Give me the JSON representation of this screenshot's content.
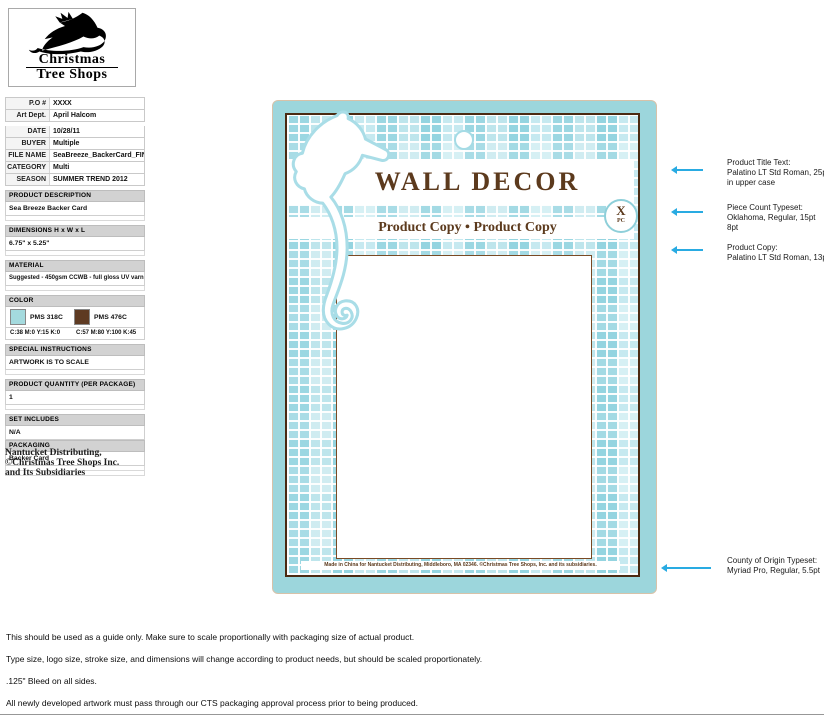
{
  "logo": {
    "line1": "Christmas",
    "line2": "Tree Shops"
  },
  "spec": {
    "fields": [
      {
        "label": "P.O #",
        "value": "XXXX"
      },
      {
        "label": "Art Dept.",
        "value": "April Halcom"
      },
      {
        "label": "DATE",
        "value": "10/28/11"
      },
      {
        "label": "BUYER",
        "value": "Multiple"
      },
      {
        "label": "FILE NAME",
        "value": "SeaBreeze_BackerCard_FINAL.ai"
      },
      {
        "label": "CATEGORY",
        "value": "Multi"
      },
      {
        "label": "SEASON",
        "value": "SUMMER TREND 2012"
      }
    ],
    "sections": {
      "description": {
        "header": "PRODUCT DESCRIPTION",
        "value": "Sea Breeze Backer Card"
      },
      "dimensions": {
        "header": "DIMENSIONS H x W x L",
        "value": "6.75\" x 5.25\""
      },
      "material": {
        "header": "MATERIAL",
        "value": "Suggested - 450gsm CCWB - full gloss UV varnish"
      },
      "color": {
        "header": "COLOR",
        "swatches": [
          {
            "name": "PMS 318C",
            "cmyk": "C:38 M:0 Y:15 K:0",
            "hex": "#a4dade"
          },
          {
            "name": "PMS 476C",
            "cmyk": "C:57 M:80 Y:100 K:45",
            "hex": "#5e3a22"
          }
        ]
      },
      "special": {
        "header": "SPECIAL INSTRUCTIONS",
        "value": "ARTWORK IS TO SCALE"
      },
      "quantity": {
        "header": "PRODUCT QUANTITY (PER PACKAGE)",
        "value": "1"
      },
      "set_includes": {
        "header": "SET INCLUDES",
        "value": "N/A"
      },
      "packaging": {
        "header": "PACKAGING",
        "value": "Backer Card"
      }
    },
    "footer_lines": [
      "Nantucket Distributing,",
      "©Christmas Tree Shops Inc.",
      "and Its Subsidiaries"
    ]
  },
  "card": {
    "title": "WALL DECOR",
    "product_copy": "Product Copy • Product Copy",
    "piece_count_x": "X",
    "piece_count_pc": "PC",
    "origin_text": "Made in China for Nantucket Distributing, Middleboro, MA 02346. ©Christmas Tree Shops, Inc. and its subsidiaries.",
    "colors": {
      "teal": "#9cd6dc",
      "brown_border": "#4a2a12",
      "text_brown": "#5c3a1d",
      "arrow_cyan": "#29abe2"
    }
  },
  "annotations": {
    "items": [
      {
        "lines": [
          "Product Title Text:",
          "Palatino LT Std Roman, 25pt",
          "in upper case"
        ]
      },
      {
        "lines": [
          "Piece Count Typeset:",
          "Oklahoma, Regular, 15pt",
          "8pt"
        ]
      },
      {
        "lines": [
          "Product Copy:",
          "Palatino LT Std Roman, 13pt"
        ]
      },
      {
        "lines": [
          "County of Origin Typeset:",
          "Myriad Pro, Regular, 5.5pt"
        ]
      }
    ]
  },
  "notes": [
    "This should be used as a guide only. Make sure to scale proportionally with packaging size of actual product.",
    "Type size, logo size, stroke size, and dimensions will change according to product needs, but should be scaled proportionately.",
    ".125\" Bleed on all sides.",
    "All newly developed artwork must pass through our CTS packaging approval process prior to being produced."
  ]
}
